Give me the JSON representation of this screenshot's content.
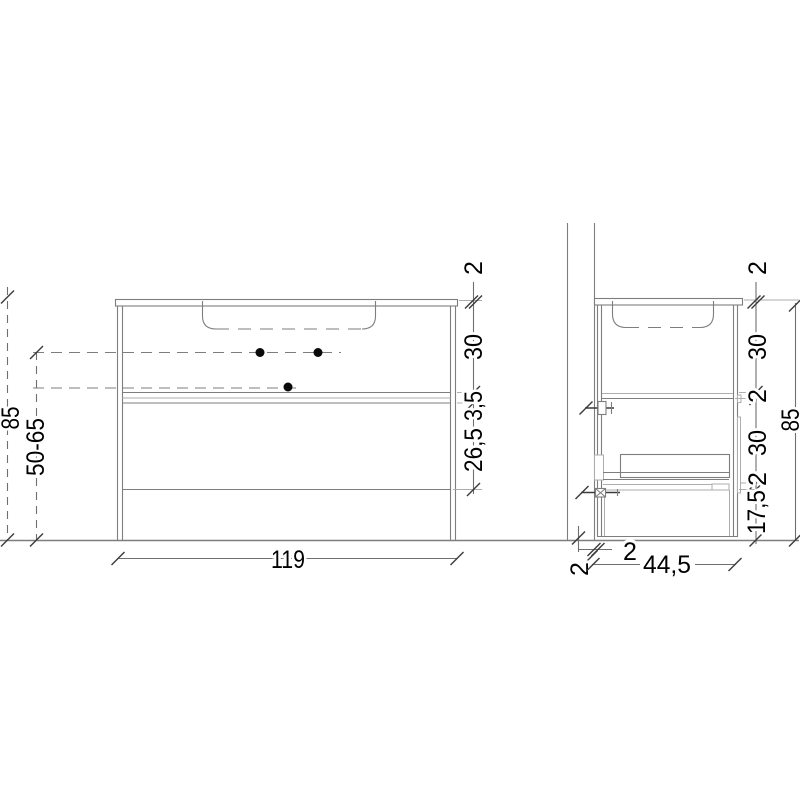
{
  "front_view": {
    "width": "119",
    "overall_height": "85",
    "install_height": "50-65",
    "countertop_thickness": "2",
    "top_drawer_height": "30",
    "drawer_gap": "3,5",
    "bottom_drawer_height": "26,5"
  },
  "side_view": {
    "depth": "44,5",
    "overall_height": "85",
    "countertop_thickness": "2",
    "basin_zone_height": "30",
    "shelf_thickness": "2",
    "drawer_zone_height": "30",
    "bottom_panel_thickness": "2",
    "floor_clearance": "17,5",
    "wall_gap": "2",
    "wall_offset": "2"
  }
}
